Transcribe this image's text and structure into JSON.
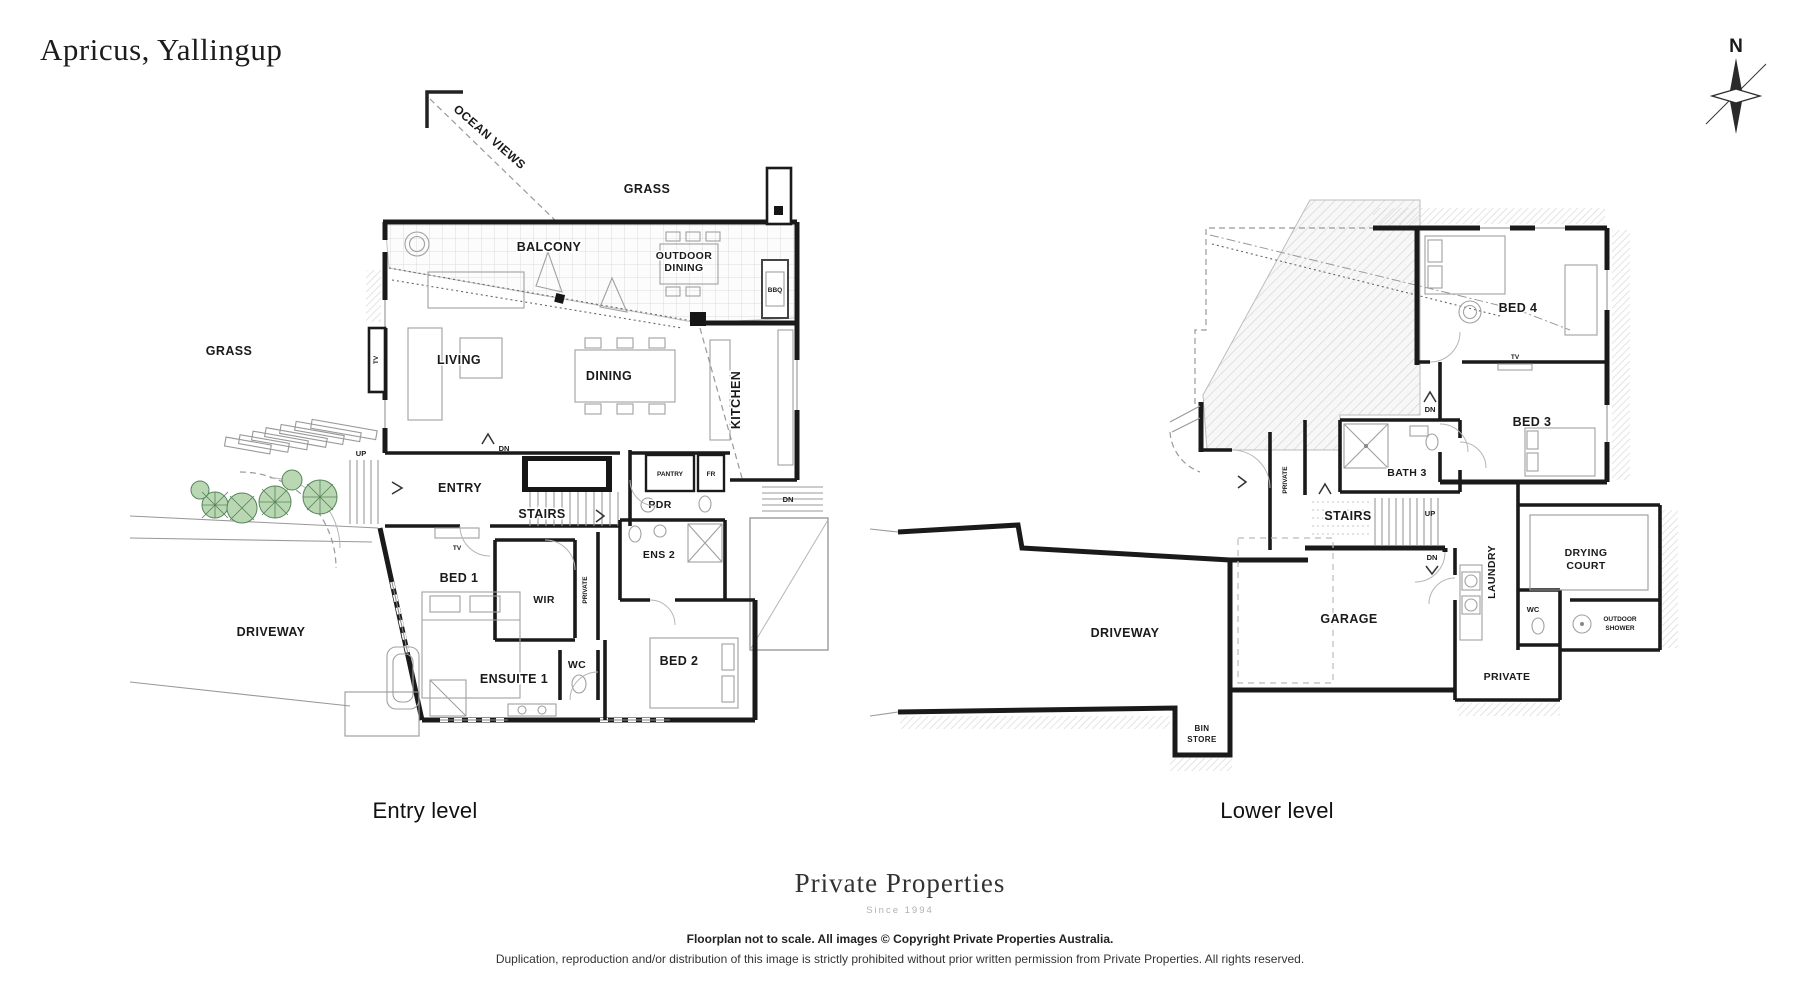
{
  "page": {
    "title": "Apricus, Yallingup",
    "compass_n": "N",
    "ocean_views": "OCEAN VIEWS"
  },
  "captions": {
    "entry": "Entry level",
    "lower": "Lower level"
  },
  "footer": {
    "brand": "Private Properties",
    "since": "Since 1994",
    "line1": "Floorplan not to scale. All images © Copyright Private Properties Australia.",
    "line2": "Duplication, reproduction and/or distribution of this image is strictly prohibited without prior written permission from Private Properties. All rights reserved."
  },
  "entry_level": {
    "grass_top": "GRASS",
    "grass_left": "GRASS",
    "balcony": "BALCONY",
    "outdoor_dining_l1": "OUTDOOR",
    "outdoor_dining_l2": "DINING",
    "bbq": "BBQ",
    "living": "LIVING",
    "dining": "DINING",
    "kitchen": "KITCHEN",
    "entry": "ENTRY",
    "stairs": "STAIRS",
    "dn": "DN",
    "dn_ext": "DN",
    "up": "UP",
    "tv_wall": "TV",
    "tv_unit": "TV",
    "pantry": "PANTRY",
    "fr": "FR",
    "pdr": "PDR",
    "ens2": "ENS 2",
    "bed1": "BED 1",
    "wir": "WIR",
    "private": "PRIVATE",
    "wc": "WC",
    "ensuite1": "ENSUITE 1",
    "bed2": "BED 2",
    "driveway": "DRIVEWAY"
  },
  "lower_level": {
    "bed4": "BED 4",
    "tv": "TV",
    "bed3": "BED 3",
    "bath3": "BATH 3",
    "dn_upper": "DN",
    "dn_lower": "DN",
    "private_hall": "PRIVATE",
    "stairs": "STAIRS",
    "up": "UP",
    "laundry": "LAUNDRY",
    "drying_court_l1": "DRYING",
    "drying_court_l2": "COURT",
    "wc": "WC",
    "outdoor_shower_l1": "OUTDOOR",
    "outdoor_shower_l2": "SHOWER",
    "garage": "GARAGE",
    "driveway": "DRIVEWAY",
    "private_room": "PRIVATE",
    "bin_store_l1": "BIN",
    "bin_store_l2": "STORE"
  },
  "colors": {
    "wall": "#1a1a1a",
    "tree_fill": "#b9d7b2",
    "tree_stroke": "#56845a",
    "hatch": "#cfcfcf"
  }
}
